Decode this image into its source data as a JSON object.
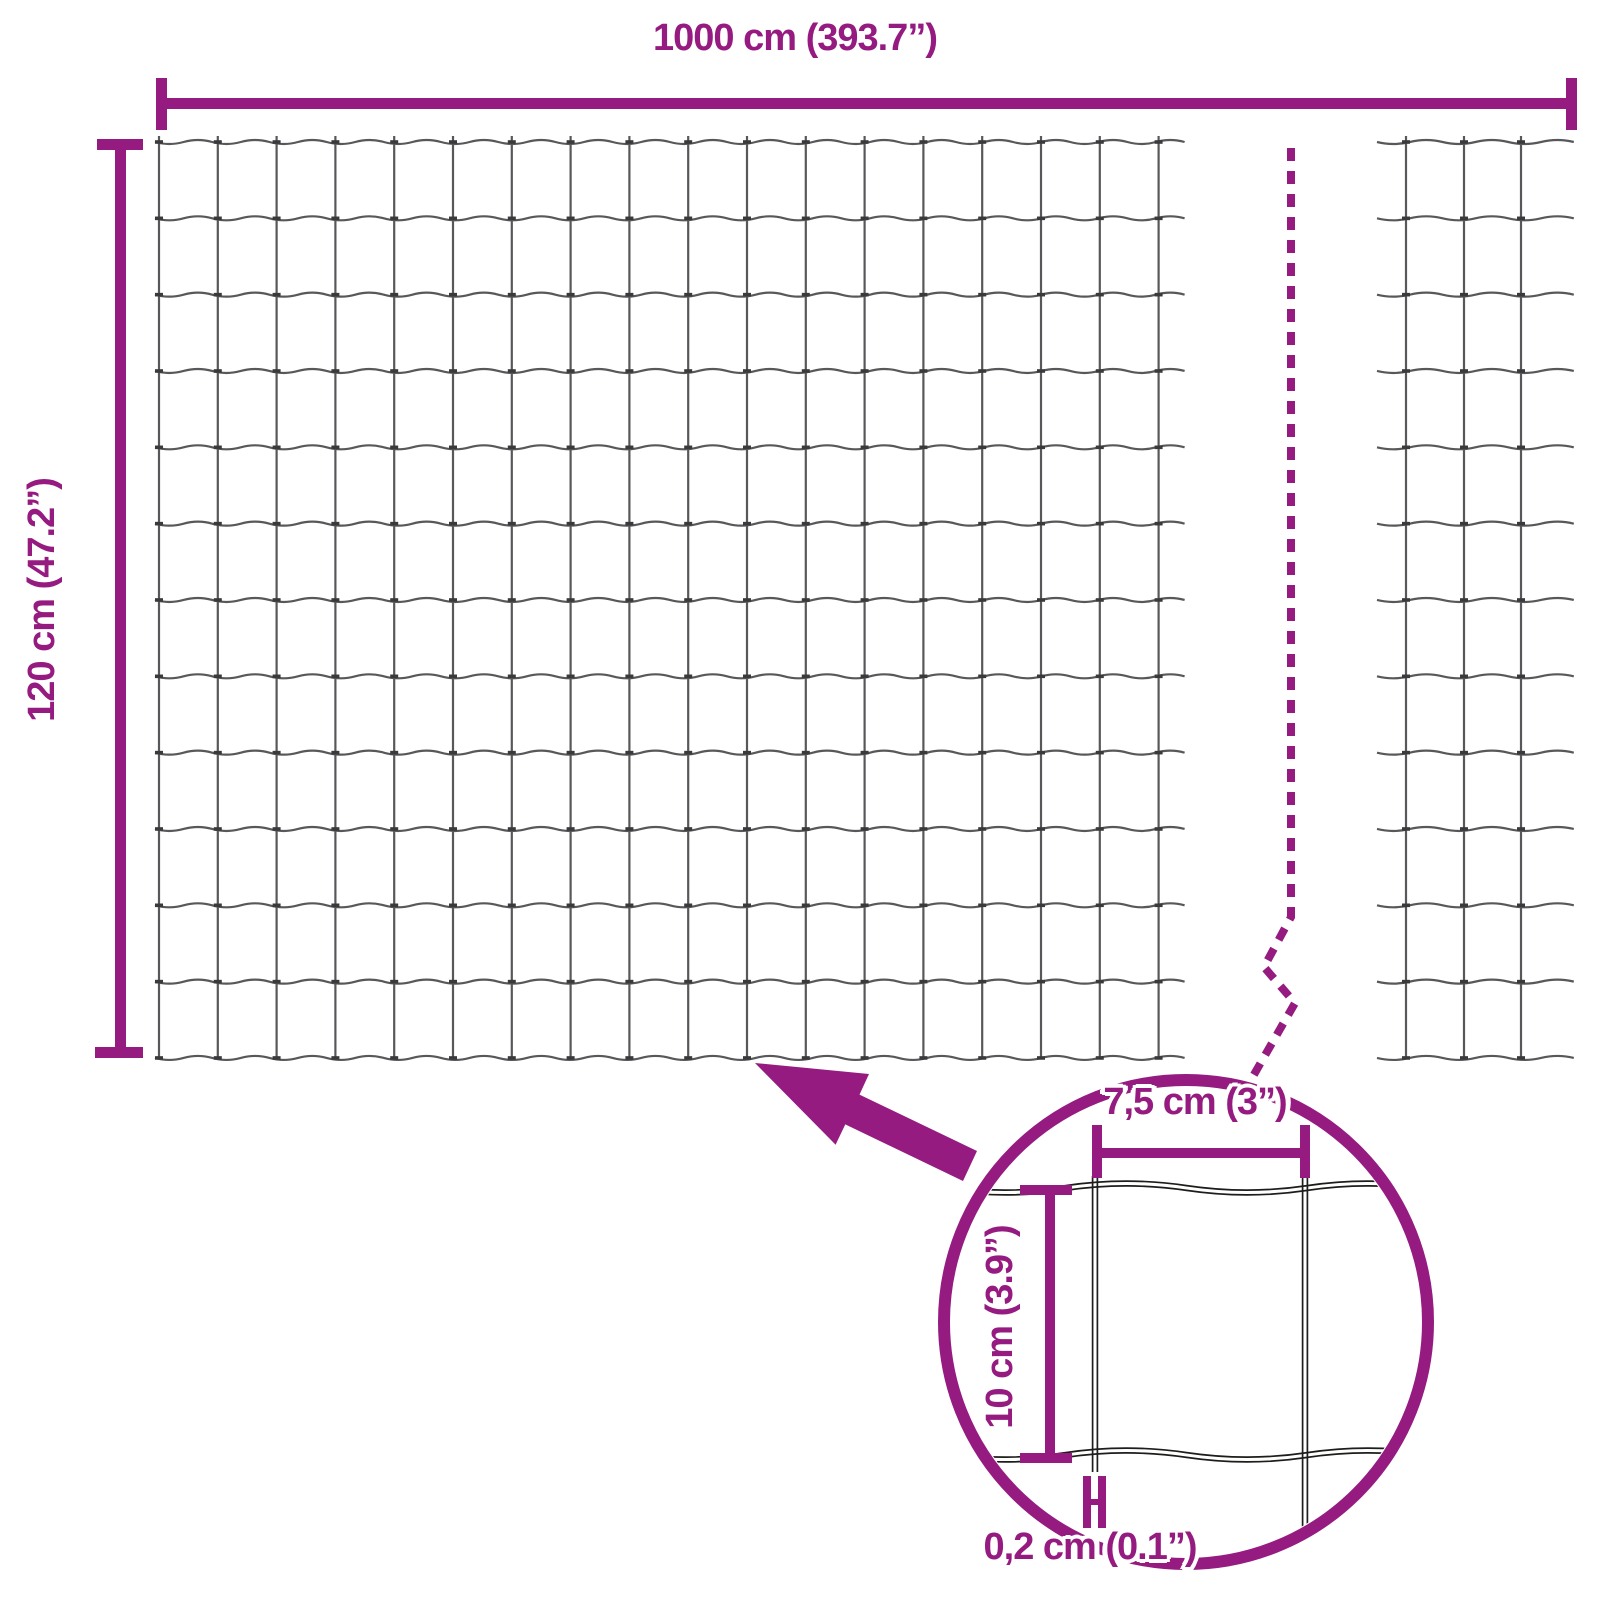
{
  "labels": {
    "total_width": "1000 cm (393.7”)",
    "total_height": "120 cm (47.2”)",
    "mesh_opening_width": "7,5 cm (3”)",
    "mesh_opening_height": "10 cm (3.9”)",
    "wire_thickness": "0,2 cm (0.1”)"
  },
  "colors": {
    "accent": "#951b81",
    "wire": "#58585a",
    "wire_node": "#3a3a3c",
    "detail_wire": "#1d1d1b",
    "background": "#ffffff"
  }
}
